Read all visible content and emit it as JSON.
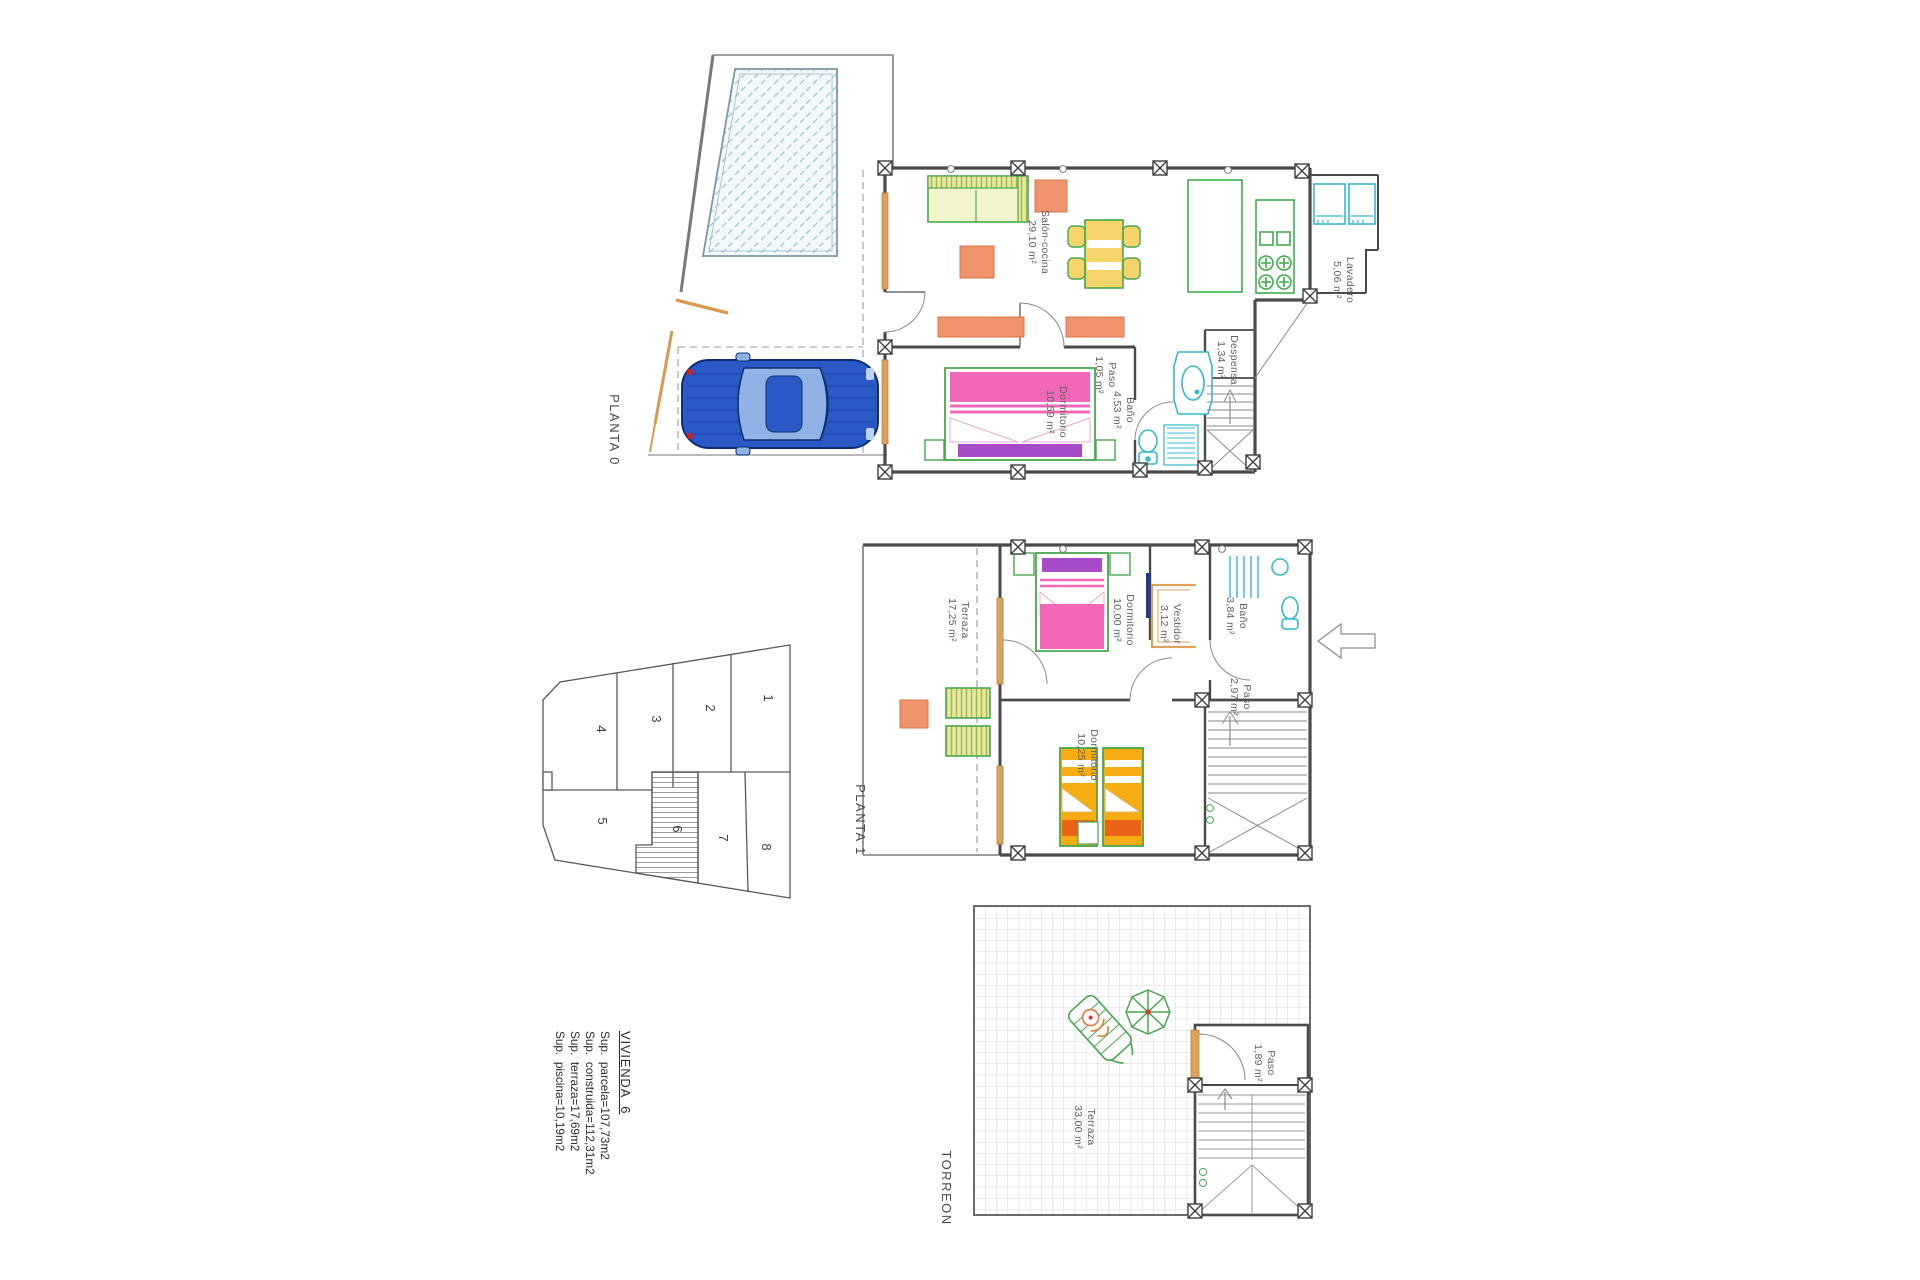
{
  "plans": {
    "planta0": {
      "title": "PLANTA 0",
      "rooms": [
        {
          "name": "Salón-cocina",
          "area": "29,10 m²"
        },
        {
          "name": "Paso",
          "area": "1,05 m²"
        },
        {
          "name": "Dormitorio",
          "area": "10,59 m²"
        },
        {
          "name": "Baño",
          "area": "4,53 m²"
        },
        {
          "name": "Despensa",
          "area": "1,34 m²"
        },
        {
          "name": "Lavadero",
          "area": "5,06 m²"
        }
      ]
    },
    "planta1": {
      "title": "PLANTA 1",
      "rooms": [
        {
          "name": "Terraza",
          "area": "17,25 m²"
        },
        {
          "name": "Dormitorio",
          "area": "10,00 m²"
        },
        {
          "name": "Vestidor",
          "area": "3,12 m²"
        },
        {
          "name": "Baño",
          "area": "3,84 m²"
        },
        {
          "name": "Paso",
          "area": "2,97 m²"
        },
        {
          "name": "Dormitorio",
          "area": "10,25 m²"
        }
      ]
    },
    "torreon": {
      "title": "TORREON",
      "rooms": [
        {
          "name": "Terraza",
          "area": "33,00 m²"
        },
        {
          "name": "Paso",
          "area": "1,89 m²"
        }
      ]
    }
  },
  "site_plan": {
    "lots": [
      "1",
      "2",
      "3",
      "4",
      "5",
      "6",
      "7",
      "8"
    ],
    "highlighted_lot": "6"
  },
  "summary": {
    "heading": "VIVIENDA  6",
    "lines": [
      "Sup.  parcela=107,73m2",
      "Sup.  construida=112,31m2",
      "Sup.  terraza=17,69m2",
      "Sup.  piscina=10,19m2"
    ]
  },
  "colors": {
    "wall": "#4a4a4a",
    "pool_hatch": "#a0c9da",
    "car_blue": "#2a58c6",
    "furniture_green": "#49a84f",
    "furniture_yellow": "#f6d36b",
    "accent_orange": "#f0946e",
    "frame_orange": "#dba35c",
    "bed_pink": "#f268b8",
    "bed_purple": "#a74bc9",
    "bed_yellow": "#f5ad13",
    "bed_deep_orange": "#ea6317",
    "sanitary_cyan": "#35b8cf"
  }
}
